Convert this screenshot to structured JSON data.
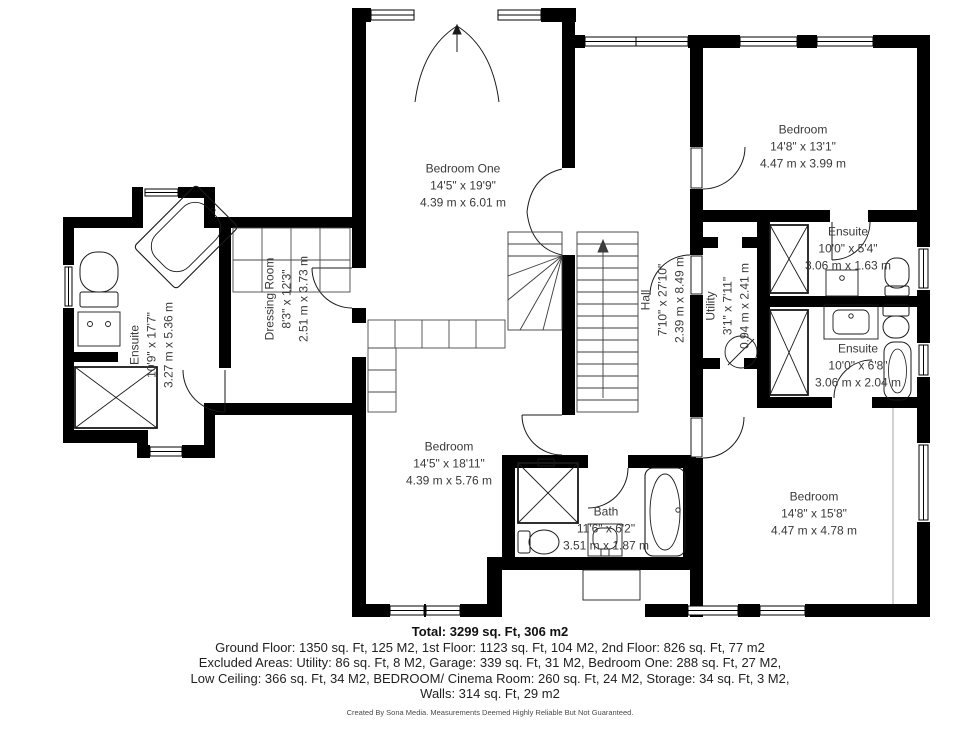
{
  "rooms": {
    "bedroom_one": {
      "name": "Bedroom One",
      "imperial": "14'5\" x 19'9\"",
      "metric": "4.39 m x 6.01 m"
    },
    "bedroom_top_right": {
      "name": "Bedroom",
      "imperial": "14'8\" x 13'1\"",
      "metric": "4.47 m x 3.99 m"
    },
    "ensuite_left": {
      "name": "Ensuite",
      "imperial": "10'9\" x 17'7\"",
      "metric": "3.27 m x 5.36 m"
    },
    "dressing_room": {
      "name": "Dressing Room",
      "imperial": "8'3\" x 12'3\"",
      "metric": "2.51 m x 3.73 m"
    },
    "hall": {
      "name": "Hall",
      "imperial": "7'10\" x 27'10\"",
      "metric": "2.39 m x 8.49 m"
    },
    "utility": {
      "name": "Utility",
      "imperial": "3'1\" x 7'11\"",
      "metric": "0.94 m x 2.41 m"
    },
    "ensuite_right_top": {
      "name": "Ensuite",
      "imperial": "10'0\" x 5'4\"",
      "metric": "3.06 m x 1.63 m"
    },
    "ensuite_right_bottom": {
      "name": "Ensuite",
      "imperial": "10'0\" x 6'8\"",
      "metric": "3.06 m x 2.04 m"
    },
    "bedroom_bottom_middle": {
      "name": "Bedroom",
      "imperial": "14'5\" x 18'11\"",
      "metric": "4.39 m x 5.76 m"
    },
    "bath": {
      "name": "Bath",
      "imperial": "11'6\" x 6'2\"",
      "metric": "3.51 m x 1.87 m"
    },
    "bedroom_bottom_right": {
      "name": "Bedroom",
      "imperial": "14'8\" x 15'8\"",
      "metric": "4.47 m x 4.78 m"
    }
  },
  "summary": {
    "total": "Total: 3299 sq. Ft, 306 m2",
    "line1": "Ground Floor: 1350 sq. Ft, 125 M2, 1st Floor: 1123 sq. Ft, 104 M2, 2nd Floor: 826 sq. Ft, 77 m2",
    "line2": "Excluded Areas: Utility: 86 sq. Ft, 8 M2, Garage: 339 sq. Ft, 31 M2, Bedroom One: 288 sq. Ft, 27 M2,",
    "line3": "Low Ceiling: 366 sq. Ft, 34 M2, BEDROOM/ Cinema Room: 260 sq. Ft, 24 M2, Storage: 34 sq. Ft, 3 M2,",
    "line4": "Walls: 314 sq. Ft, 29 m2"
  },
  "footer": "Created By Sona Media. Measurements Deemed Highly Reliable But Not Guaranteed.",
  "colors": {
    "wall": "#000000",
    "label_text": "#3a3a3a",
    "summary_text": "#1f1f1f",
    "footer_text": "#4a4a4a"
  }
}
